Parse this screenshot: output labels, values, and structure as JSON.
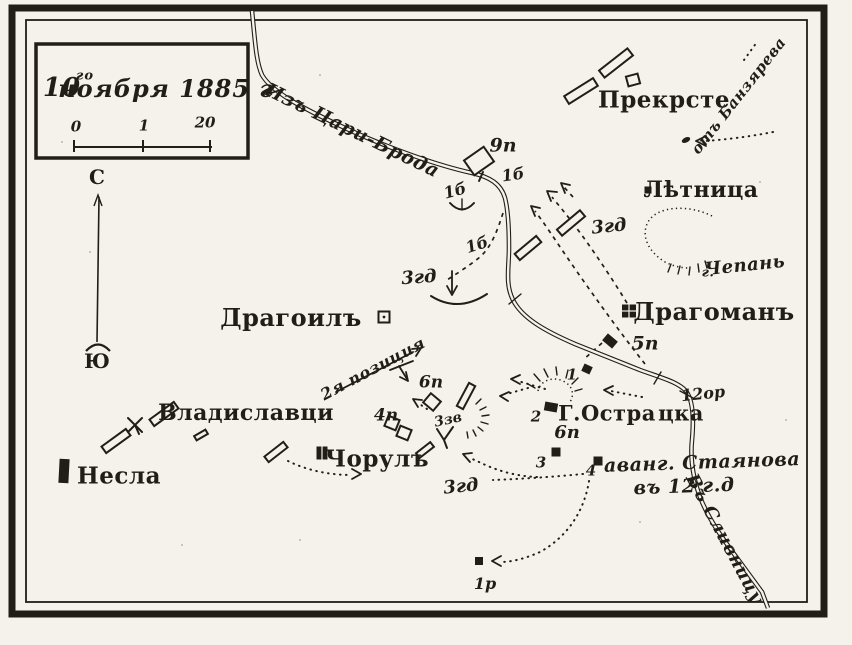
{
  "map": {
    "colors": {
      "paper": "#f4f2eb",
      "ink": "#211d17"
    },
    "legend": {
      "date": "10го ноября 1885 г.",
      "scale_ticks": [
        "0",
        "1",
        "20"
      ]
    },
    "compass": {
      "north": "С",
      "south": "Ю"
    },
    "labels": [
      {
        "n": "date-day",
        "t": "10",
        "x": 62,
        "y": 88,
        "r": 0,
        "s": 26,
        "c": "date"
      },
      {
        "n": "date-superscript",
        "t": "го",
        "x": 85,
        "y": 76,
        "r": 0,
        "s": 13,
        "c": "date"
      },
      {
        "n": "date-rest",
        "t": "ноября 1885 г",
        "x": 166,
        "y": 89,
        "r": 0,
        "s": 24,
        "c": "date"
      },
      {
        "n": "scale-0",
        "t": "0",
        "x": 76,
        "y": 127,
        "r": 0,
        "s": 15,
        "c": "scale"
      },
      {
        "n": "scale-1",
        "t": "1",
        "x": 144,
        "y": 126,
        "r": 0,
        "s": 15,
        "c": "scale"
      },
      {
        "n": "scale-20",
        "t": "20",
        "x": 205,
        "y": 123,
        "r": 0,
        "s": 15,
        "c": "scale"
      },
      {
        "n": "compass-north",
        "t": "С",
        "x": 97,
        "y": 177,
        "r": 0,
        "s": 20,
        "c": "comp"
      },
      {
        "n": "compass-south",
        "t": "Ю",
        "x": 97,
        "y": 361,
        "r": 0,
        "s": 20,
        "c": "comp"
      },
      {
        "n": "road-from-tsaribrod",
        "t": "Изъ Цари-Брода",
        "x": 352,
        "y": 131,
        "r": 26,
        "s": 19,
        "c": "annot"
      },
      {
        "n": "annot-ot-banzyareva",
        "t": "отъ Банзярева",
        "x": 739,
        "y": 96,
        "r": -52,
        "s": 15,
        "c": "annot"
      },
      {
        "n": "town-prekrste",
        "t": "Прекрсте",
        "x": 664,
        "y": 100,
        "r": 0,
        "s": 23,
        "c": "town"
      },
      {
        "n": "town-letnitsa",
        "t": "Лѣтница",
        "x": 701,
        "y": 190,
        "r": 0,
        "s": 22,
        "c": "town"
      },
      {
        "n": "mount-chepan-prefix",
        "t": "г.",
        "x": 708,
        "y": 273,
        "r": 0,
        "s": 13,
        "c": "annot"
      },
      {
        "n": "mount-chepan",
        "t": "Чепань",
        "x": 745,
        "y": 266,
        "r": -6,
        "s": 18,
        "c": "annot"
      },
      {
        "n": "town-dragoman",
        "t": "Драгоманъ",
        "x": 714,
        "y": 312,
        "r": 0,
        "s": 24,
        "c": "town"
      },
      {
        "n": "town-dragoil",
        "t": "Драгоилъ",
        "x": 291,
        "y": 318,
        "r": 0,
        "s": 24,
        "c": "town"
      },
      {
        "n": "town-vladislavtsi",
        "t": "Владиславци",
        "x": 246,
        "y": 413,
        "r": 0,
        "s": 22,
        "c": "town"
      },
      {
        "n": "town-nesla",
        "t": "Несла",
        "x": 119,
        "y": 476,
        "r": 0,
        "s": 23,
        "c": "town"
      },
      {
        "n": "town-chorul",
        "t": "Чорулъ",
        "x": 377,
        "y": 459,
        "r": 0,
        "s": 23,
        "c": "town"
      },
      {
        "n": "hill-ostra-part1",
        "t": "Г.Остра",
        "x": 607,
        "y": 413,
        "r": 0,
        "s": 21,
        "c": "town"
      },
      {
        "n": "hill-ostra-part2",
        "t": "цка",
        "x": 681,
        "y": 413,
        "r": 0,
        "s": 21,
        "c": "town"
      },
      {
        "n": "annot-position-2",
        "t": "2я позиция",
        "x": 373,
        "y": 369,
        "r": -28,
        "s": 16,
        "c": "annot"
      },
      {
        "n": "annot-avangard-stayanova",
        "t": "аванг. Стаянова",
        "x": 702,
        "y": 463,
        "r": -2,
        "s": 19,
        "c": "annot"
      },
      {
        "n": "annot-avangard-line2",
        "t": "въ 12 г.д",
        "x": 684,
        "y": 487,
        "r": -2,
        "s": 19,
        "c": "annot"
      },
      {
        "n": "road-to-slivnitsa",
        "t": "Въ Сливницу",
        "x": 724,
        "y": 539,
        "r": 62,
        "s": 18,
        "c": "annot"
      },
      {
        "n": "unit-9p",
        "t": "9п",
        "x": 503,
        "y": 146,
        "r": 0,
        "s": 19,
        "c": "unit"
      },
      {
        "n": "unit-1b-road",
        "t": "1б",
        "x": 513,
        "y": 175,
        "r": -8,
        "s": 16,
        "c": "unit"
      },
      {
        "n": "unit-1b-bend",
        "t": "1б",
        "x": 455,
        "y": 191,
        "r": -15,
        "s": 16,
        "c": "unit"
      },
      {
        "n": "unit-1b-mid",
        "t": "1б",
        "x": 477,
        "y": 245,
        "r": -18,
        "s": 16,
        "c": "unit"
      },
      {
        "n": "unit-3gd-west",
        "t": "3гд",
        "x": 419,
        "y": 278,
        "r": -4,
        "s": 18,
        "c": "unit"
      },
      {
        "n": "unit-3gd-east",
        "t": "3гд",
        "x": 609,
        "y": 227,
        "r": -6,
        "s": 18,
        "c": "unit"
      },
      {
        "n": "unit-5p",
        "t": "5п",
        "x": 645,
        "y": 344,
        "r": 0,
        "s": 19,
        "c": "unit"
      },
      {
        "n": "unit-12or",
        "t": "12ор",
        "x": 703,
        "y": 394,
        "r": -6,
        "s": 16,
        "c": "unit"
      },
      {
        "n": "marker-1",
        "t": "1",
        "x": 572,
        "y": 375,
        "r": 0,
        "s": 15,
        "c": "unit"
      },
      {
        "n": "marker-2",
        "t": "2",
        "x": 536,
        "y": 417,
        "r": 0,
        "s": 15,
        "c": "unit"
      },
      {
        "n": "unit-6p-east",
        "t": "6п",
        "x": 567,
        "y": 433,
        "r": 0,
        "s": 18,
        "c": "unit"
      },
      {
        "n": "marker-3",
        "t": "3",
        "x": 541,
        "y": 463,
        "r": 0,
        "s": 15,
        "c": "unit"
      },
      {
        "n": "marker-4",
        "t": "4",
        "x": 591,
        "y": 471,
        "r": 0,
        "s": 15,
        "c": "unit"
      },
      {
        "n": "unit-6p-west",
        "t": "6п",
        "x": 431,
        "y": 383,
        "r": 0,
        "s": 17,
        "c": "unit"
      },
      {
        "n": "unit-4p",
        "t": "4п",
        "x": 386,
        "y": 416,
        "r": 0,
        "s": 17,
        "c": "unit"
      },
      {
        "n": "unit-3zv",
        "t": "3зв",
        "x": 448,
        "y": 420,
        "r": -12,
        "s": 14,
        "c": "unit"
      },
      {
        "n": "unit-3gd-south",
        "t": "3гд",
        "x": 461,
        "y": 487,
        "r": -6,
        "s": 18,
        "c": "unit"
      },
      {
        "n": "unit-1r",
        "t": "1р",
        "x": 485,
        "y": 584,
        "r": 0,
        "s": 16,
        "c": "unit"
      }
    ]
  }
}
